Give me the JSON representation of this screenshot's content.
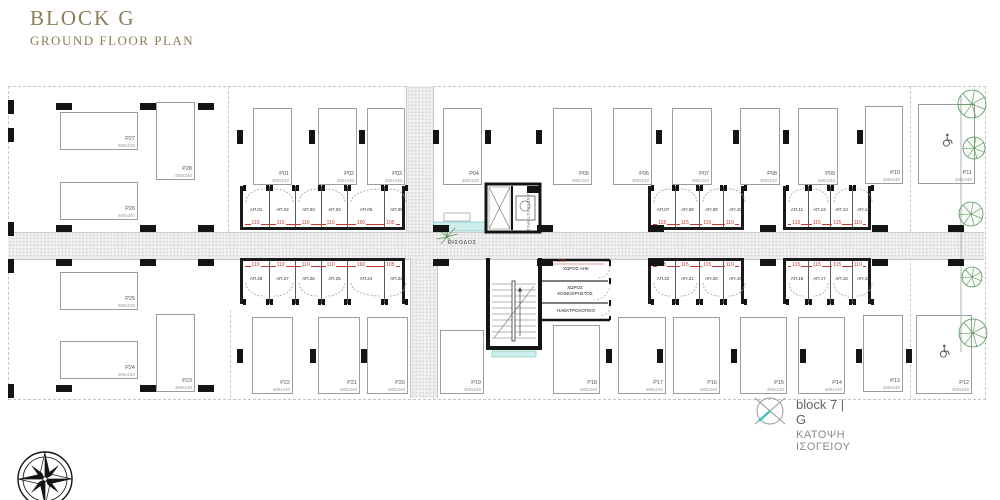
{
  "title": {
    "main": "BLOCK G",
    "sub": "GROUND FLOOR PLAN"
  },
  "legend": {
    "block_label": "block 7 | G",
    "floor_label": "ΚΑΤΟΨΗ ΙΣΟΓΕΙΟΥ"
  },
  "core": {
    "entrance_label": "ΕΙΣΟΔΟΣ",
    "elevator_label": "ΑΝΕΛΚΥΣΤΗΡΑΣ",
    "dim": "240",
    "rooms": [
      {
        "name": "ΧΩΡΟΣ ΑΗΚ"
      },
      {
        "name": "ΧΩΡΟΣ ΚΟΙΝΟΧΡΗΣΤΟΣ"
      },
      {
        "name": "ΗΛΕΚΤΡΟΛΟΓΕΙΟ"
      }
    ]
  },
  "colors": {
    "title": "#8c7d58",
    "walls": "#141414",
    "dims_red": "#c23b2e",
    "teal_accent": "#35c0b5",
    "teal_fill": "#cdeeea",
    "tree_green": "#4f9150",
    "hatch_gray": "#efefef"
  },
  "plan": {
    "roads": [
      {
        "x": 8,
        "y": 232,
        "w": 976,
        "h": 26,
        "v": false
      },
      {
        "x": 406,
        "y": 86,
        "w": 26,
        "h": 146,
        "v": true
      },
      {
        "x": 410,
        "y": 258,
        "w": 26,
        "h": 140,
        "v": true
      }
    ],
    "dashes": [
      {
        "x": 228,
        "y": 86,
        "h": 146
      },
      {
        "x": 910,
        "y": 86,
        "h": 146
      },
      {
        "x": 910,
        "y": 258,
        "h": 140
      },
      {
        "x": 230,
        "y": 310,
        "h": 88
      }
    ],
    "parking": [
      {
        "label": "P27",
        "size": "480x240",
        "x": 60,
        "y": 112,
        "w": 78,
        "h": 38
      },
      {
        "label": "P28",
        "size": "480x240",
        "x": 156,
        "y": 102,
        "w": 39,
        "h": 78
      },
      {
        "label": "P26",
        "size": "480x240",
        "x": 60,
        "y": 182,
        "w": 78,
        "h": 38
      },
      {
        "label": "P01",
        "size": "480x240",
        "x": 253,
        "y": 108,
        "w": 39,
        "h": 77
      },
      {
        "label": "P02",
        "size": "480x240",
        "x": 318,
        "y": 108,
        "w": 39,
        "h": 77
      },
      {
        "label": "P03",
        "size": "480x240",
        "x": 367,
        "y": 108,
        "w": 38,
        "h": 77
      },
      {
        "label": "P04",
        "size": "480x240",
        "x": 443,
        "y": 108,
        "w": 39,
        "h": 77
      },
      {
        "label": "P05",
        "size": "480x240",
        "x": 553,
        "y": 108,
        "w": 39,
        "h": 77
      },
      {
        "label": "P06",
        "size": "480x240",
        "x": 613,
        "y": 108,
        "w": 39,
        "h": 77
      },
      {
        "label": "P07",
        "size": "480x240",
        "x": 672,
        "y": 108,
        "w": 40,
        "h": 77
      },
      {
        "label": "P08",
        "size": "480x240",
        "x": 740,
        "y": 108,
        "w": 40,
        "h": 77
      },
      {
        "label": "P09",
        "size": "480x240",
        "x": 798,
        "y": 108,
        "w": 40,
        "h": 77
      },
      {
        "label": "P10",
        "size": "480x240",
        "x": 865,
        "y": 106,
        "w": 38,
        "h": 78
      },
      {
        "label": "P11",
        "size": "480x240",
        "x": 918,
        "y": 104,
        "w": 57,
        "h": 80,
        "disabled": true
      },
      {
        "label": "P25",
        "size": "480x240",
        "x": 60,
        "y": 272,
        "w": 78,
        "h": 38
      },
      {
        "label": "P24",
        "size": "480x240",
        "x": 60,
        "y": 341,
        "w": 78,
        "h": 38
      },
      {
        "label": "P23",
        "size": "480x240",
        "x": 156,
        "y": 314,
        "w": 39,
        "h": 78
      },
      {
        "label": "P22",
        "size": "480x240",
        "x": 252,
        "y": 317,
        "w": 41,
        "h": 77
      },
      {
        "label": "P21",
        "size": "480x240",
        "x": 318,
        "y": 317,
        "w": 42,
        "h": 77
      },
      {
        "label": "P20",
        "size": "480x240",
        "x": 367,
        "y": 317,
        "w": 41,
        "h": 77
      },
      {
        "label": "P19",
        "size": "480x240",
        "x": 440,
        "y": 330,
        "w": 44,
        "h": 64
      },
      {
        "label": "P18",
        "size": "480x240",
        "x": 553,
        "y": 325,
        "w": 47,
        "h": 69
      },
      {
        "label": "P17",
        "size": "480x240",
        "x": 618,
        "y": 317,
        "w": 48,
        "h": 77
      },
      {
        "label": "P16",
        "size": "480x240",
        "x": 673,
        "y": 317,
        "w": 47,
        "h": 77
      },
      {
        "label": "P15",
        "size": "480x240",
        "x": 740,
        "y": 317,
        "w": 47,
        "h": 77
      },
      {
        "label": "P14",
        "size": "480x240",
        "x": 798,
        "y": 317,
        "w": 47,
        "h": 77
      },
      {
        "label": "P13",
        "size": "480x240",
        "x": 863,
        "y": 315,
        "w": 40,
        "h": 77
      },
      {
        "label": "P12",
        "size": "480x240",
        "x": 916,
        "y": 315,
        "w": 56,
        "h": 79,
        "disabled": true
      }
    ],
    "storage_groups": [
      {
        "x": 240,
        "y": 186,
        "h": 44,
        "side": "top",
        "units": [
          {
            "label": "ΑΠ.01",
            "dim": "110",
            "w": 26
          },
          {
            "label": "ΑΠ.02",
            "dim": "110",
            "w": 26
          },
          {
            "label": "ΑΠ.03",
            "dim": "110",
            "w": 26
          },
          {
            "label": "ΑΠ.04",
            "dim": "110",
            "w": 26
          },
          {
            "label": "ΑΠ.05",
            "dim": "160",
            "w": 37
          },
          {
            "label": "ΑΠ.06",
            "dim": "105",
            "w": 24
          }
        ]
      },
      {
        "x": 240,
        "y": 258,
        "h": 46,
        "side": "bottom",
        "units": [
          {
            "label": "ΑΠ.28",
            "dim": "110",
            "w": 26
          },
          {
            "label": "ΑΠ.27",
            "dim": "110",
            "w": 26
          },
          {
            "label": "ΑΠ.26",
            "dim": "110",
            "w": 26
          },
          {
            "label": "ΑΠ.25",
            "dim": "110",
            "w": 26
          },
          {
            "label": "ΑΠ.24",
            "dim": "160",
            "w": 37
          },
          {
            "label": "ΑΠ.23",
            "dim": "105",
            "w": 24
          }
        ]
      },
      {
        "x": 648,
        "y": 186,
        "h": 44,
        "side": "top",
        "units": [
          {
            "label": "ΑΠ.07",
            "dim": "115",
            "w": 24
          },
          {
            "label": "ΑΠ.08",
            "dim": "115",
            "w": 24
          },
          {
            "label": "ΑΠ.09",
            "dim": "115",
            "w": 24
          },
          {
            "label": "ΑΠ.10",
            "dim": "110",
            "w": 24
          }
        ]
      },
      {
        "x": 783,
        "y": 186,
        "h": 44,
        "side": "top",
        "units": [
          {
            "label": "ΑΠ.11",
            "dim": "115",
            "w": 22
          },
          {
            "label": "ΑΠ.12",
            "dim": "115",
            "w": 22
          },
          {
            "label": "ΑΠ.13",
            "dim": "115",
            "w": 22
          },
          {
            "label": "ΑΠ.14",
            "dim": "110",
            "w": 22
          }
        ]
      },
      {
        "x": 648,
        "y": 258,
        "h": 46,
        "side": "bottom",
        "units": [
          {
            "label": "ΑΠ.22",
            "dim": "115",
            "w": 24
          },
          {
            "label": "ΑΠ.21",
            "dim": "115",
            "w": 24
          },
          {
            "label": "ΑΠ.20",
            "dim": "115",
            "w": 24
          },
          {
            "label": "ΑΠ.19",
            "dim": "110",
            "w": 24
          }
        ]
      },
      {
        "x": 783,
        "y": 258,
        "h": 46,
        "side": "bottom",
        "units": [
          {
            "label": "ΑΠ.18",
            "dim": "115",
            "w": 22
          },
          {
            "label": "ΑΠ.17",
            "dim": "115",
            "w": 22
          },
          {
            "label": "ΑΠ.16",
            "dim": "115",
            "w": 22
          },
          {
            "label": "ΑΠ.15",
            "dim": "110",
            "w": 22
          }
        ]
      }
    ],
    "columns_h": [
      {
        "x": 56,
        "y": 225
      },
      {
        "x": 140,
        "y": 225
      },
      {
        "x": 198,
        "y": 225
      },
      {
        "x": 433,
        "y": 225
      },
      {
        "x": 537,
        "y": 225
      },
      {
        "x": 648,
        "y": 225
      },
      {
        "x": 760,
        "y": 225
      },
      {
        "x": 872,
        "y": 225
      },
      {
        "x": 948,
        "y": 225
      },
      {
        "x": 56,
        "y": 259
      },
      {
        "x": 140,
        "y": 259
      },
      {
        "x": 198,
        "y": 259
      },
      {
        "x": 433,
        "y": 259
      },
      {
        "x": 537,
        "y": 259
      },
      {
        "x": 648,
        "y": 259
      },
      {
        "x": 760,
        "y": 259
      },
      {
        "x": 872,
        "y": 259
      },
      {
        "x": 948,
        "y": 259
      },
      {
        "x": 56,
        "y": 103
      },
      {
        "x": 140,
        "y": 103
      },
      {
        "x": 198,
        "y": 103
      },
      {
        "x": 56,
        "y": 385
      },
      {
        "x": 140,
        "y": 385
      },
      {
        "x": 198,
        "y": 385
      }
    ],
    "columns_v": [
      {
        "x": 237,
        "y": 130
      },
      {
        "x": 309,
        "y": 130
      },
      {
        "x": 359,
        "y": 130
      },
      {
        "x": 433,
        "y": 130
      },
      {
        "x": 485,
        "y": 130
      },
      {
        "x": 536,
        "y": 130
      },
      {
        "x": 656,
        "y": 130
      },
      {
        "x": 733,
        "y": 130
      },
      {
        "x": 783,
        "y": 130
      },
      {
        "x": 857,
        "y": 130
      },
      {
        "x": 237,
        "y": 349
      },
      {
        "x": 310,
        "y": 349
      },
      {
        "x": 361,
        "y": 349
      },
      {
        "x": 606,
        "y": 349
      },
      {
        "x": 657,
        "y": 349
      },
      {
        "x": 731,
        "y": 349
      },
      {
        "x": 800,
        "y": 349
      },
      {
        "x": 856,
        "y": 349
      },
      {
        "x": 906,
        "y": 349
      },
      {
        "x": 8,
        "y": 100
      },
      {
        "x": 8,
        "y": 128
      },
      {
        "x": 8,
        "y": 222
      },
      {
        "x": 8,
        "y": 259
      },
      {
        "x": 8,
        "y": 384
      }
    ],
    "trees": [
      {
        "cx": 972,
        "cy": 104,
        "r": 14
      },
      {
        "cx": 974,
        "cy": 148,
        "r": 11
      },
      {
        "cx": 971,
        "cy": 214,
        "r": 12
      },
      {
        "cx": 972,
        "cy": 277,
        "r": 10
      },
      {
        "cx": 973,
        "cy": 333,
        "r": 14
      }
    ]
  }
}
